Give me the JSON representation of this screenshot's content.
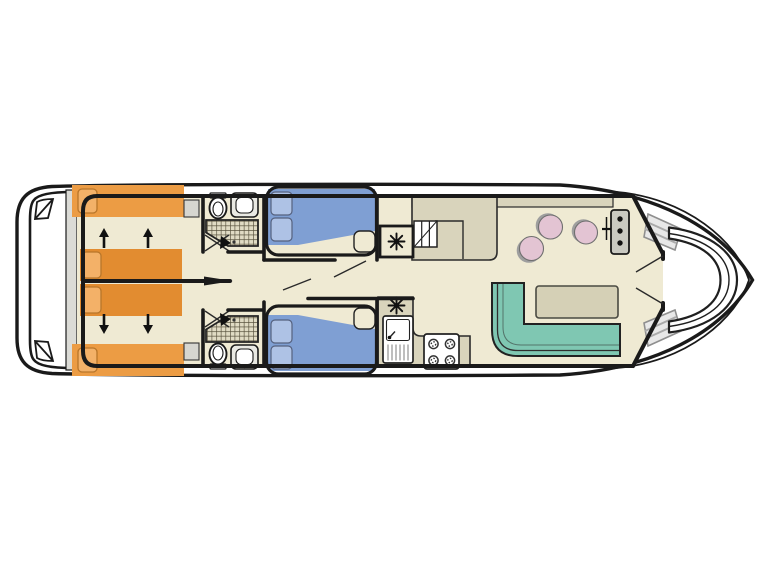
{
  "meta": {
    "title": "Houseboat deck floor plan",
    "type": "floor-plan",
    "view": "top-down",
    "bow_side": "right",
    "stern_side": "left"
  },
  "colors": {
    "background": "#FFFFFF",
    "hull_white": "#FFFFFF",
    "wall_black": "#1A1A1A",
    "door_line": "#2A2A2A",
    "floor_cream": "#EFEAD3",
    "counter_beige": "#D9D4BC",
    "bed_single_orange": "#EC9C44",
    "bed_single_orange_dark": "#E28C30",
    "pillow_orange": "#F3B168",
    "bed_double_blue": "#7F9FD3",
    "pillow_blue": "#AEC2E5",
    "sofa_teal": "#7FC7B2",
    "table_beige": "#D5D0B6",
    "stool_pink": "#E3C4D3",
    "stool_shadow_gray": "#9E9E9E",
    "cabinet_gray": "#D6D6D0",
    "console_gray": "#C9C9C1",
    "transom_gray": "#DBDBD6",
    "steps_gray": "#E8E8E8",
    "shower_tile_bg": "#E0DBC4",
    "shower_tile_line": "#554F3B",
    "fixture_white": "#FFFFFF"
  },
  "inventory": {
    "stern": {
      "features": [
        "swim-platform",
        "boarding-steps"
      ]
    },
    "aft_cabin": {
      "single_berths": 4,
      "pillows": 4,
      "bedside_cabinets": 2,
      "slide_arrows_up": 2,
      "slide_arrows_down": 2,
      "note": "four orange single berths, centre pair slides to convert"
    },
    "bathrooms": {
      "count": 2,
      "fixtures_each": [
        "toilet",
        "washbasin",
        "shower"
      ]
    },
    "double_cabins": {
      "count": 2,
      "double_berths": 2,
      "pillows_each": 2,
      "foot_seat_each": 1
    },
    "wardrobe_heater_symbols": 2,
    "galley": {
      "fixtures": [
        "sink-with-drainer",
        "four-burner-hob",
        "counters",
        "companionway-steps"
      ]
    },
    "saloon": {
      "furniture": [
        "l-shaped-sofa",
        "table",
        "stool",
        "stool",
        "stool"
      ]
    },
    "helm": {
      "features": [
        "instrument-console",
        "three-gauges",
        "throttle-lever"
      ]
    },
    "bow_cockpit": {
      "furniture": [
        "curved-bench"
      ],
      "step_flights": 2
    }
  }
}
